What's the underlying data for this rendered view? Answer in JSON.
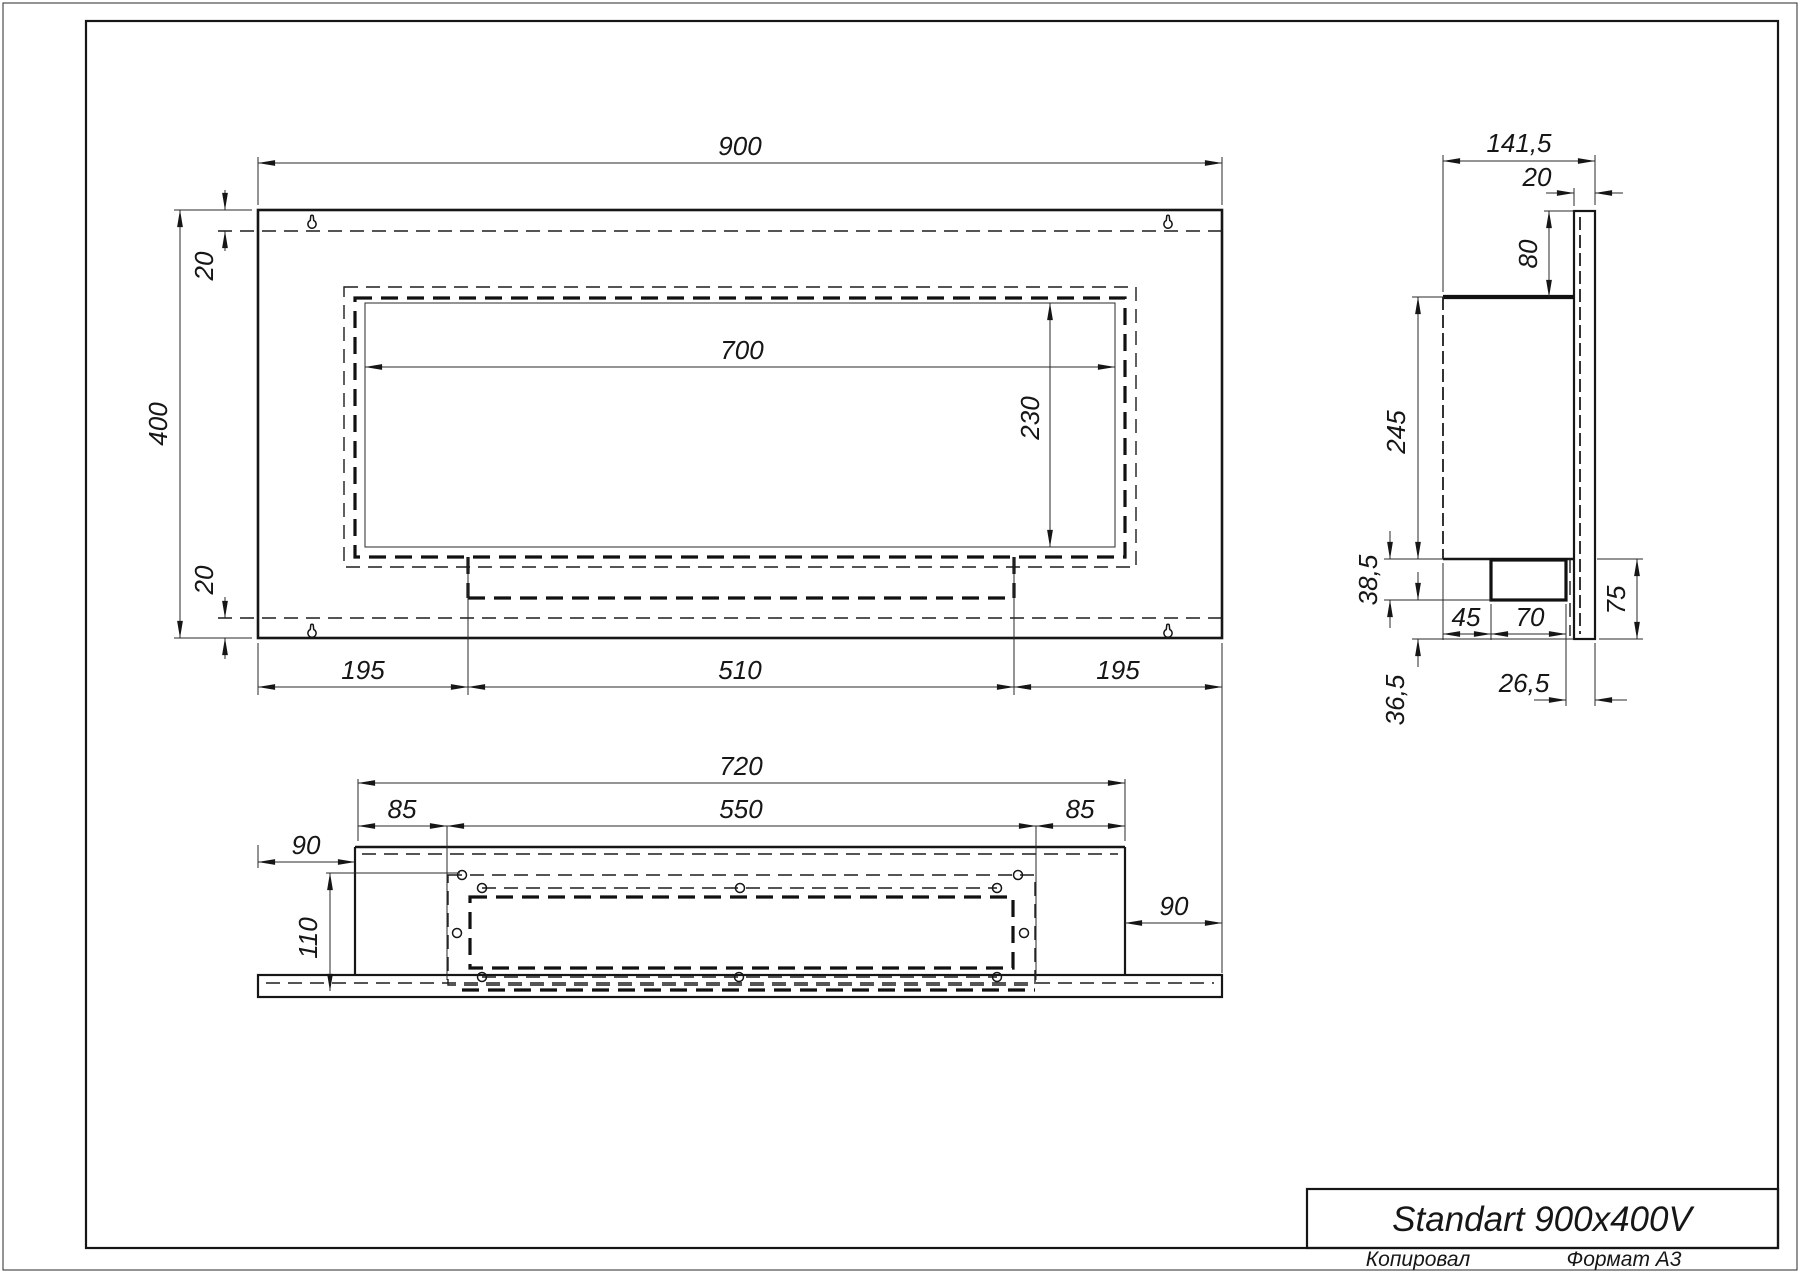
{
  "page": {
    "background": "#ffffff",
    "line_color": "#161616"
  },
  "title_block": {
    "title": "Standart 900x400V",
    "copied_label": "Копировал",
    "format_label": "Формат А3"
  },
  "front_view": {
    "dim_width": "900",
    "dim_height": "400",
    "dim_top_inset": "20",
    "dim_bottom_inset": "20",
    "dim_opening_width": "700",
    "dim_opening_height": "230",
    "dim_left_segment": "195",
    "dim_center_segment": "510",
    "dim_right_segment": "195"
  },
  "side_view": {
    "dim_depth": "141,5",
    "dim_plate_thickness": "20",
    "dim_top_gap": "80",
    "dim_body_height": "245",
    "dim_tray_height": "38,5",
    "dim_bottom_gap": "36,5",
    "dim_tray_offset": "45",
    "dim_tray_width": "70",
    "dim_lower_height": "75",
    "dim_back_offset": "26,5"
  },
  "bottom_view": {
    "dim_body_width": "720",
    "dim_opening_width": "550",
    "dim_left_margin": "85",
    "dim_right_margin": "85",
    "dim_left_offset": "90",
    "dim_right_offset": "90",
    "dim_depth": "110"
  }
}
